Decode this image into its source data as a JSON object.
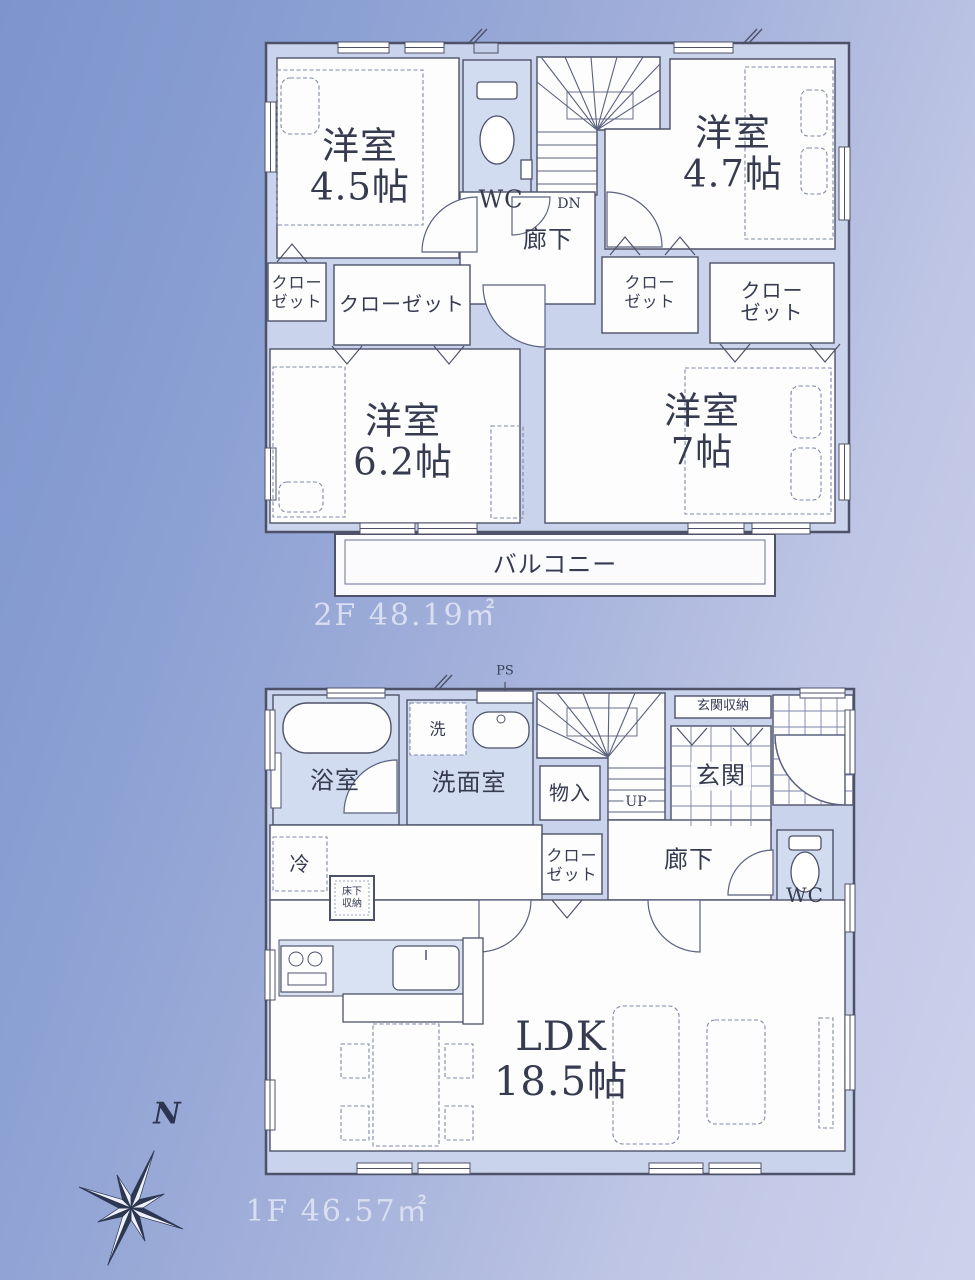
{
  "colors": {
    "background_top_left": "#7d95cc",
    "background_bottom_right": "#cdd2ec",
    "wall_fill": "#c9d3ec",
    "line": "#4d5269",
    "room_fill": "#fdfdfe",
    "shaded_floor": "#d2dcf1",
    "text": "#363b50",
    "area_label_text": "#d9dff1",
    "compass_dark": "#2c3852"
  },
  "floor2": {
    "area_label": "2F 48.19㎡",
    "rooms": {
      "bedroom_45": "洋室\n4.5帖",
      "bedroom_47": "洋室\n4.7帖",
      "bedroom_62": "洋室\n6.2帖",
      "bedroom_7": "洋室\n7帖",
      "wc": "WC",
      "hallway": "廊下",
      "balcony": "バルコニー"
    },
    "stairs_down_label": "DN",
    "closets": {
      "left_small": "クロー\nゼット",
      "left_wide": "クローゼット",
      "right_small": "クロー\nゼット",
      "right_wide": "クローゼット"
    }
  },
  "floor1": {
    "area_label": "1F 46.57㎡",
    "rooms": {
      "bathroom": "浴室",
      "washroom": "洗面室",
      "washer": "洗",
      "pipe_space": "PS",
      "entrance_storage": "玄関収納",
      "entrance": "玄関",
      "storage": "物入",
      "closet": "クロー\nゼット",
      "hallway": "廊下",
      "wc": "WC",
      "refrigerator": "冷",
      "underfloor_storage": "床下\n収納",
      "ldk": "LDK\n18.5帖"
    },
    "stairs_up_label": "UP"
  },
  "compass": {
    "north_label": "N"
  }
}
